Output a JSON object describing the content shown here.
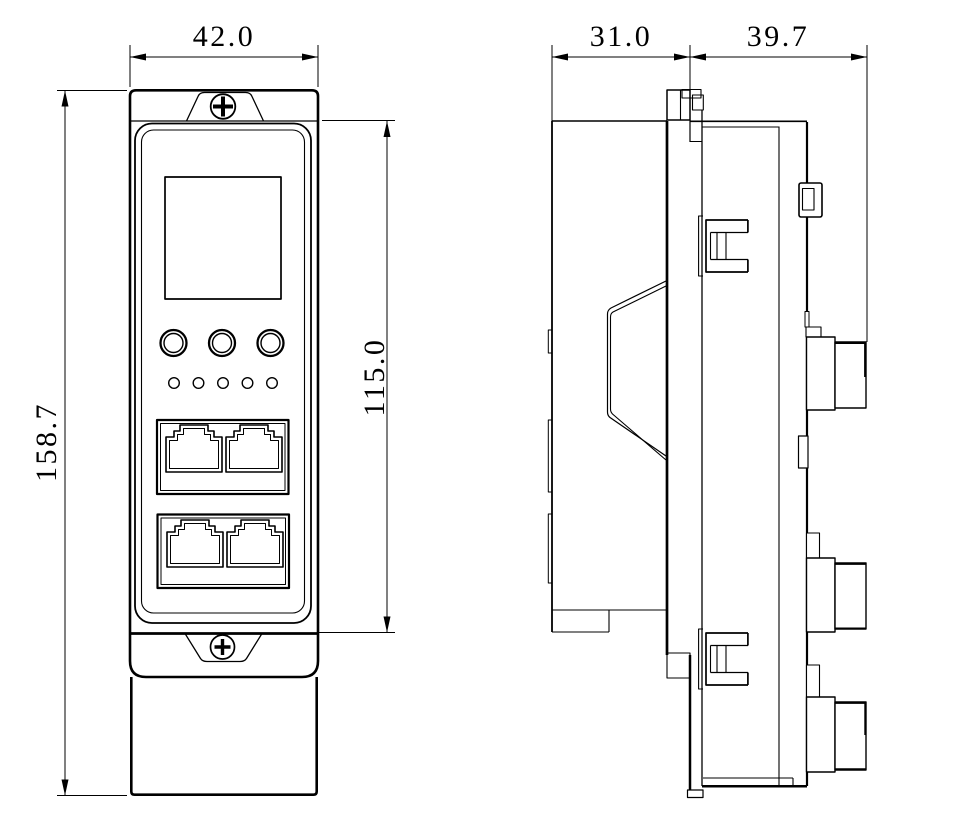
{
  "drawing": {
    "type": "engineering-dimension-drawing",
    "views": {
      "front_view": "front-view",
      "side_view": "side-view"
    },
    "dimensions": {
      "front_width": "42.0",
      "front_overall_height": "158.7",
      "front_panel_height": "115.0",
      "side_mount_depth": "31.0",
      "side_body_depth": "39.7"
    },
    "colors": {
      "line": "#000000",
      "background": "#ffffff"
    }
  }
}
